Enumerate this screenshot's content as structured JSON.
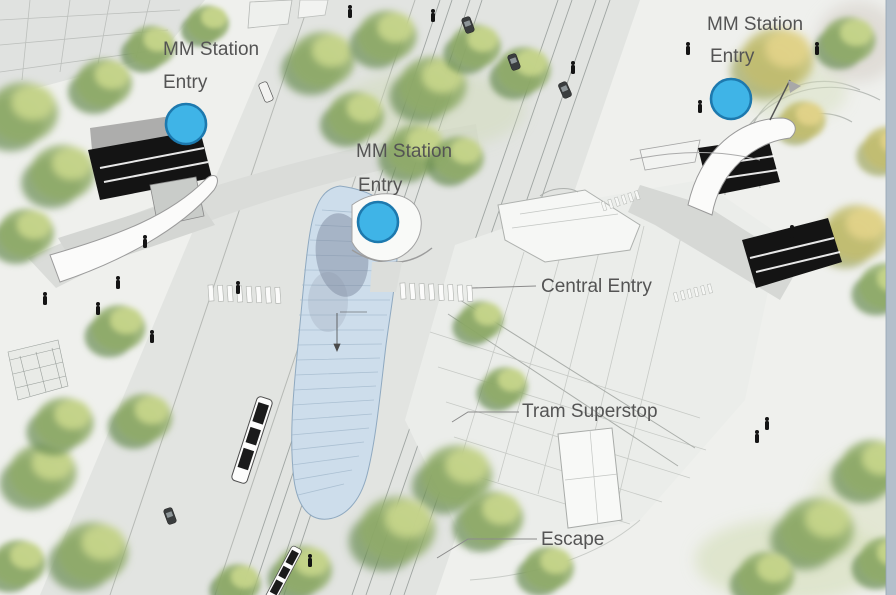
{
  "scene": {
    "name": "MM Station aerial concept rendering",
    "kind": "annotated architectural site illustration"
  },
  "colors": {
    "background": "#eff0ed",
    "right_edge_strip": "#b3bfcb",
    "road": "#e2e4e1",
    "ramp_road": "#dadcd9",
    "plaza": "#ebedea",
    "glass_canopy_fill": "#cdddeb",
    "glass_canopy_stroke": "#8fa9c0",
    "marker_fill": "#3fb4e7",
    "marker_stroke": "#1d79ae",
    "label_text": "#545454",
    "stair_black": "#141414"
  },
  "labels": {
    "station_entries": [
      {
        "id": "left",
        "line1": "MM Station",
        "line2": "Entry"
      },
      {
        "id": "center",
        "line1": "MM Station",
        "line2": "Entry"
      },
      {
        "id": "right",
        "line1": "MM Station",
        "line2": "Entry"
      }
    ],
    "central_entry": "Central Entry",
    "tram_superstop": "Tram Superstop",
    "escape": "Escape"
  },
  "markers": [
    {
      "id": "entry-left",
      "x": 186,
      "y": 124,
      "r": 20
    },
    {
      "id": "entry-center",
      "x": 378,
      "y": 222,
      "r": 20
    },
    {
      "id": "entry-right",
      "x": 731,
      "y": 99,
      "r": 20
    }
  ]
}
